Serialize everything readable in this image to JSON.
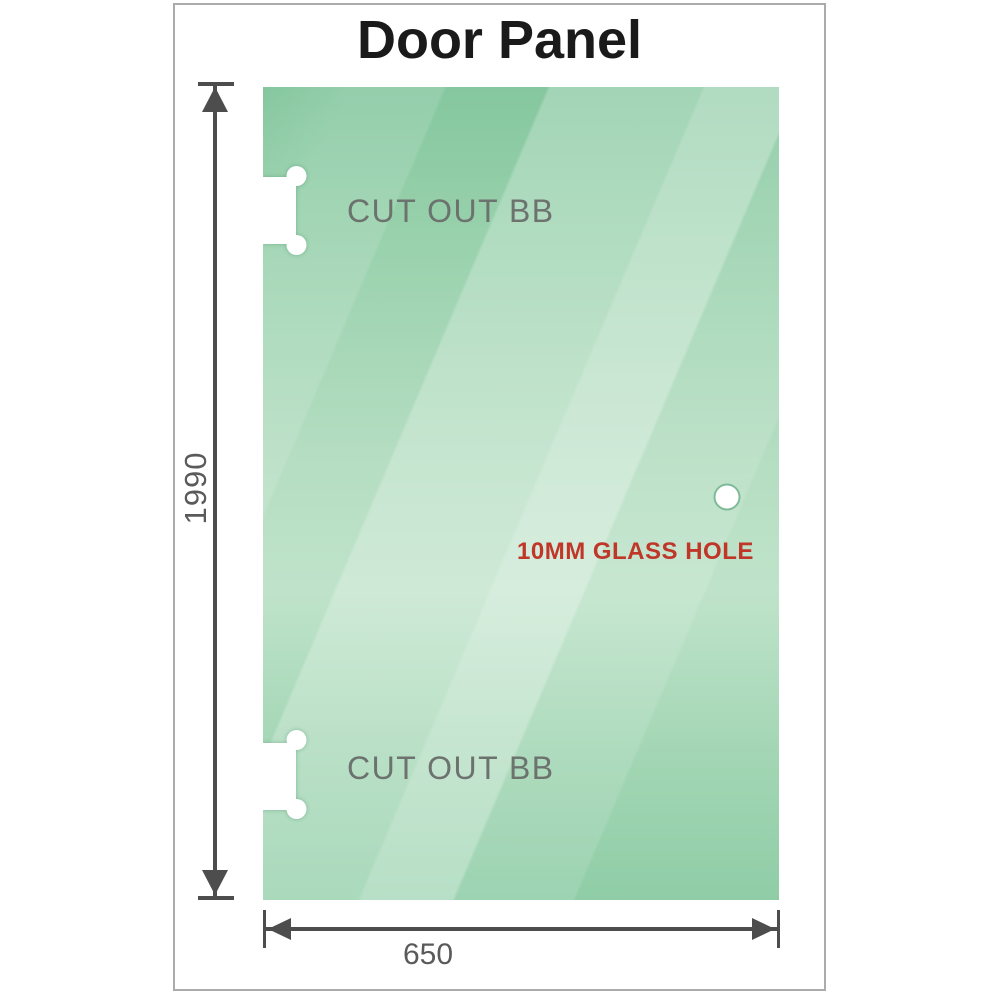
{
  "title": "Door Panel",
  "panel": {
    "material": "glass",
    "cutouts": [
      {
        "label": "CUT OUT BB"
      },
      {
        "label": "CUT OUT BB"
      }
    ],
    "hole": {
      "label": "10MM GLASS HOLE"
    }
  },
  "dimensions": {
    "height": {
      "value": "1990"
    },
    "width": {
      "value": "650"
    }
  },
  "colors": {
    "glass_top": "#85c79f",
    "glass_mid": "#bfe3ca",
    "glass_bottom": "#8fcda7",
    "dimension_line": "#4d4d4d",
    "cutout_label": "#6c726e",
    "hole_label": "#c0372a",
    "title": "#1a1a1a",
    "frame_border": "#ababab",
    "dim_text": "#5a5a5a",
    "hole_ring": "#7fbb98"
  }
}
